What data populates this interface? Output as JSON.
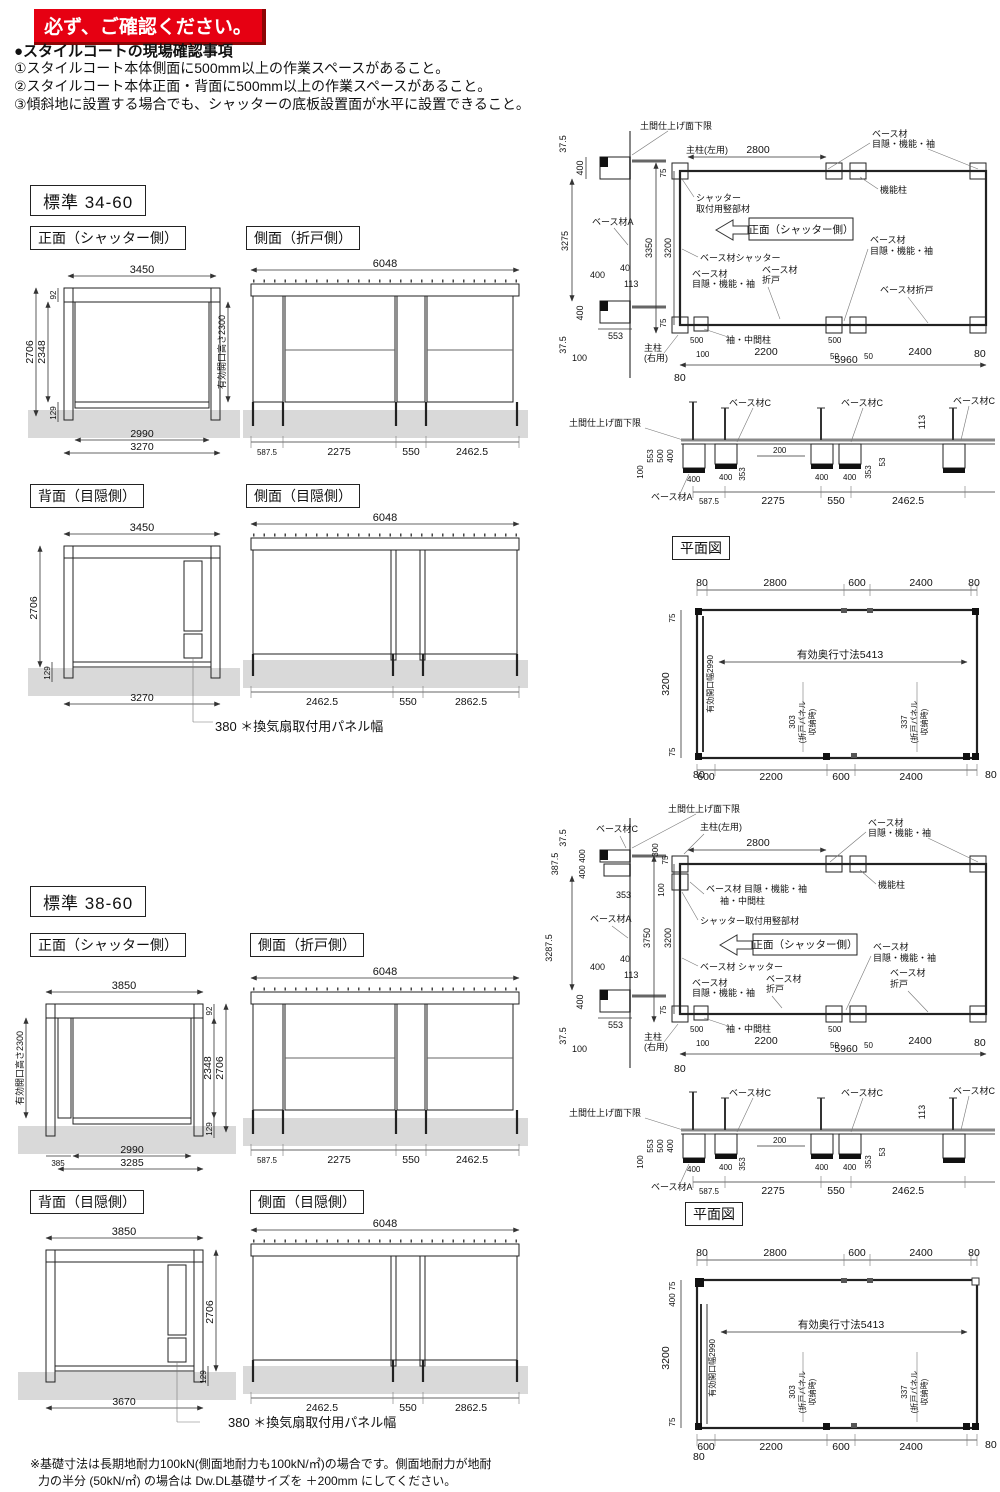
{
  "header": {
    "banner": "必ず、ご確認ください。",
    "heading": "●スタイルコートの現場確認事項",
    "notes": [
      "①スタイルコート本体側面に500mm以上の作業スペースがあること。",
      "②スタイルコート本体正面・背面に500mm以上の作業スペースがあること。",
      "③傾斜地に設置する場合でも、シャッターの底板設置面が水平に設置できること。"
    ]
  },
  "footer": {
    "line1": "※基礎寸法は長期地耐力100kN(側面地耐力も100kN/㎡)の場合です。側面地耐力が地耐",
    "line2": "力の半分 (50kN/㎡) の場合は Dw.DL基礎サイズを ＋200mm にしてください。"
  },
  "s1": {
    "title": "標準 34-60",
    "front": {
      "label": "正面（シャッター側）",
      "top": "3450",
      "d92": "92",
      "d2348": "2348",
      "d2706": "2706",
      "d129": "129",
      "opening": "有効開口高さ2300",
      "b1": "2990",
      "b2": "3270"
    },
    "side_fold": {
      "label": "側面（折戸側）",
      "top": "6048",
      "b1": "587.5",
      "b2": "2275",
      "b3": "550",
      "b4": "2462.5"
    },
    "back": {
      "label": "背面（目隠側）",
      "top": "3450",
      "h2706": "2706",
      "d129": "129",
      "b1": "3270",
      "vent": "380 ＊換気扇取付用パネル幅"
    },
    "side_screen": {
      "label": "側面（目隠側）",
      "top": "6048",
      "b1": "2462.5",
      "b2": "550",
      "b3": "2862.5"
    },
    "detail": {
      "doma": "土間仕上げ面下限",
      "lw1": "37.5",
      "lw2": "400",
      "lw3": "3275",
      "baseA": "ベース材A",
      "lw5": "400",
      "lw6": "40",
      "lw7": "113",
      "lw8": "400",
      "lw9": "553",
      "lw10": "37.5",
      "lw11": "100",
      "mpl": "主柱(左用)",
      "t75": "75",
      "t2800": "2800",
      "bt1a": "ベース材",
      "bt1b": "目隠・機能・袖",
      "kino": "機能柱",
      "sm1": "シャッター",
      "sm2": "取付用竪部材",
      "arrow": "正面（シャッター側）",
      "bsh": "ベース材シャッター",
      "bl1a": "ベース材",
      "bl1b": "目隠・機能・袖",
      "bf1a": "ベース材",
      "bf1b": "折戸",
      "br1a": "ベース材",
      "br1b": "目隠・機能・袖",
      "bfr": "ベース材折戸",
      "v3350": "3350",
      "v3200": "3200",
      "b75": "75",
      "d500l": "500",
      "sode": "袖・中間柱",
      "d500r": "500",
      "mpr1": "主柱",
      "mpr2": "(右用)",
      "b100": "100",
      "b2200": "2200",
      "b50l": "50",
      "b5960": "5960",
      "b50r": "50",
      "b2400": "2400",
      "b80r": "80",
      "b80l": "80"
    },
    "section": {
      "doma": "土間仕上げ面下限",
      "baseC1": "ベース材C",
      "baseC2": "ベース材C",
      "baseC3": "ベース材C",
      "d113": "113",
      "d553": "553",
      "d500": "500",
      "d400": "400",
      "d100": "100",
      "d400a": "400",
      "d353a": "353",
      "d200": "200",
      "d400b": "400",
      "d400c": "400",
      "d353b": "353",
      "d53": "53",
      "d400d": "400",
      "baseA": "ベース材A",
      "b1": "587.5",
      "b2": "2275",
      "b3": "550",
      "b4": "2462.5"
    },
    "plan": {
      "label": "平面図",
      "t1": "80",
      "t2": "2800",
      "t3": "600",
      "t4": "2400",
      "t5": "80",
      "l1": "75",
      "l2": "3200",
      "l3": "75",
      "opening": "有効開口幅2990",
      "depth": "有効奥行寸法5413",
      "f1a": "303",
      "f1b": "(折戸パネル",
      "f1c": "収納時)",
      "f2a": "337",
      "f2b": "(折戸パネル",
      "f2c": "収納時)",
      "b1": "600",
      "b2": "2200",
      "b3": "600",
      "b4": "2400",
      "b5": "80",
      "bl": "80"
    }
  },
  "s2": {
    "title": "標準 38-60",
    "front": {
      "label": "正面（シャッター側）",
      "top": "3850",
      "opening": "有効開口高さ2300",
      "d92": "92",
      "d2348": "2348",
      "d2706": "2706",
      "d129": "129",
      "b0": "385",
      "b1": "2990",
      "b2": "3285"
    },
    "side_fold": {
      "label": "側面（折戸側）",
      "top": "6048",
      "b1": "587.5",
      "b2": "2275",
      "b3": "550",
      "b4": "2462.5"
    },
    "back": {
      "label": "背面（目隠側）",
      "top": "3850",
      "h2706": "2706",
      "d129": "129",
      "b1": "3670",
      "vent": "380 ＊換気扇取付用パネル幅"
    },
    "side_screen": {
      "label": "側面（目隠側）",
      "top": "6048",
      "b1": "2462.5",
      "b2": "550",
      "b3": "2862.5"
    },
    "detail": {
      "doma": "土間仕上げ面下限",
      "baseC": "ベース材C",
      "lw1": "37.5",
      "lw2a": "400",
      "lw2b": "400",
      "d387": "387.5",
      "d353": "353",
      "lw3": "3287.5",
      "baseA": "ベース材A",
      "lw5": "400",
      "lw6": "40",
      "lw7": "113",
      "lw8": "400",
      "lw9": "553",
      "lw10": "37.5",
      "lw11": "100",
      "t300": "300",
      "t75": "75",
      "t100": "100",
      "mpl": "主柱(左用)",
      "t2800": "2800",
      "bt1a": "ベース材",
      "bt1b": "目隠・機能・袖",
      "blc": "ベース材 目隠・機能・袖",
      "sodeT": "袖・中間柱",
      "sm": "シャッター取付用竪部材",
      "arrow": "正面（シャッター側）",
      "bsh": "ベース材 シャッター",
      "bl1a": "ベース材",
      "bl1b": "目隠・機能・袖",
      "bf1a": "ベース材",
      "bf1b": "折戸",
      "kino": "機能柱",
      "br1a": "ベース材",
      "br1b": "目隠・機能・袖",
      "brf1": "ベース材",
      "brf2": "折戸",
      "v3750": "3750",
      "v3200": "3200",
      "b75": "75",
      "d500l": "500",
      "sode": "袖・中間柱",
      "d500r": "500",
      "mpr1": "主柱",
      "mpr2": "(右用)",
      "b100": "100",
      "b2200": "2200",
      "b50l": "50",
      "b5960": "5960",
      "b50r": "50",
      "b2400": "2400",
      "b80r": "80",
      "b80l": "80"
    },
    "section": {
      "doma": "土間仕上げ面下限",
      "baseC1": "ベース材C",
      "baseC2": "ベース材C",
      "baseC3": "ベース材C",
      "d113": "113",
      "d553": "553",
      "d500": "500",
      "d400": "400",
      "d100": "100",
      "d400a": "400",
      "d353a": "353",
      "d200": "200",
      "d400b": "400",
      "d400c": "400",
      "d353b": "353",
      "d53": "53",
      "d400d": "400",
      "baseA": "ベース材A",
      "b1": "587.5",
      "b2": "2275",
      "b3": "550",
      "b4": "2462.5"
    },
    "plan": {
      "label": "平面図",
      "t1": "80",
      "t2": "2800",
      "t3": "600",
      "t4": "2400",
      "t5": "80",
      "l0": "75",
      "l0b": "400",
      "l2": "3200",
      "l3": "75",
      "opening": "有効開口幅2990",
      "depth": "有効奥行寸法5413",
      "f1a": "303",
      "f1b": "(折戸パネル",
      "f1c": "収納時)",
      "f2a": "337",
      "f2b": "(折戸パネル",
      "f2c": "収納時)",
      "b1": "600",
      "b2": "2200",
      "b3": "600",
      "b4": "2400",
      "b5": "80",
      "bl": "80"
    }
  }
}
